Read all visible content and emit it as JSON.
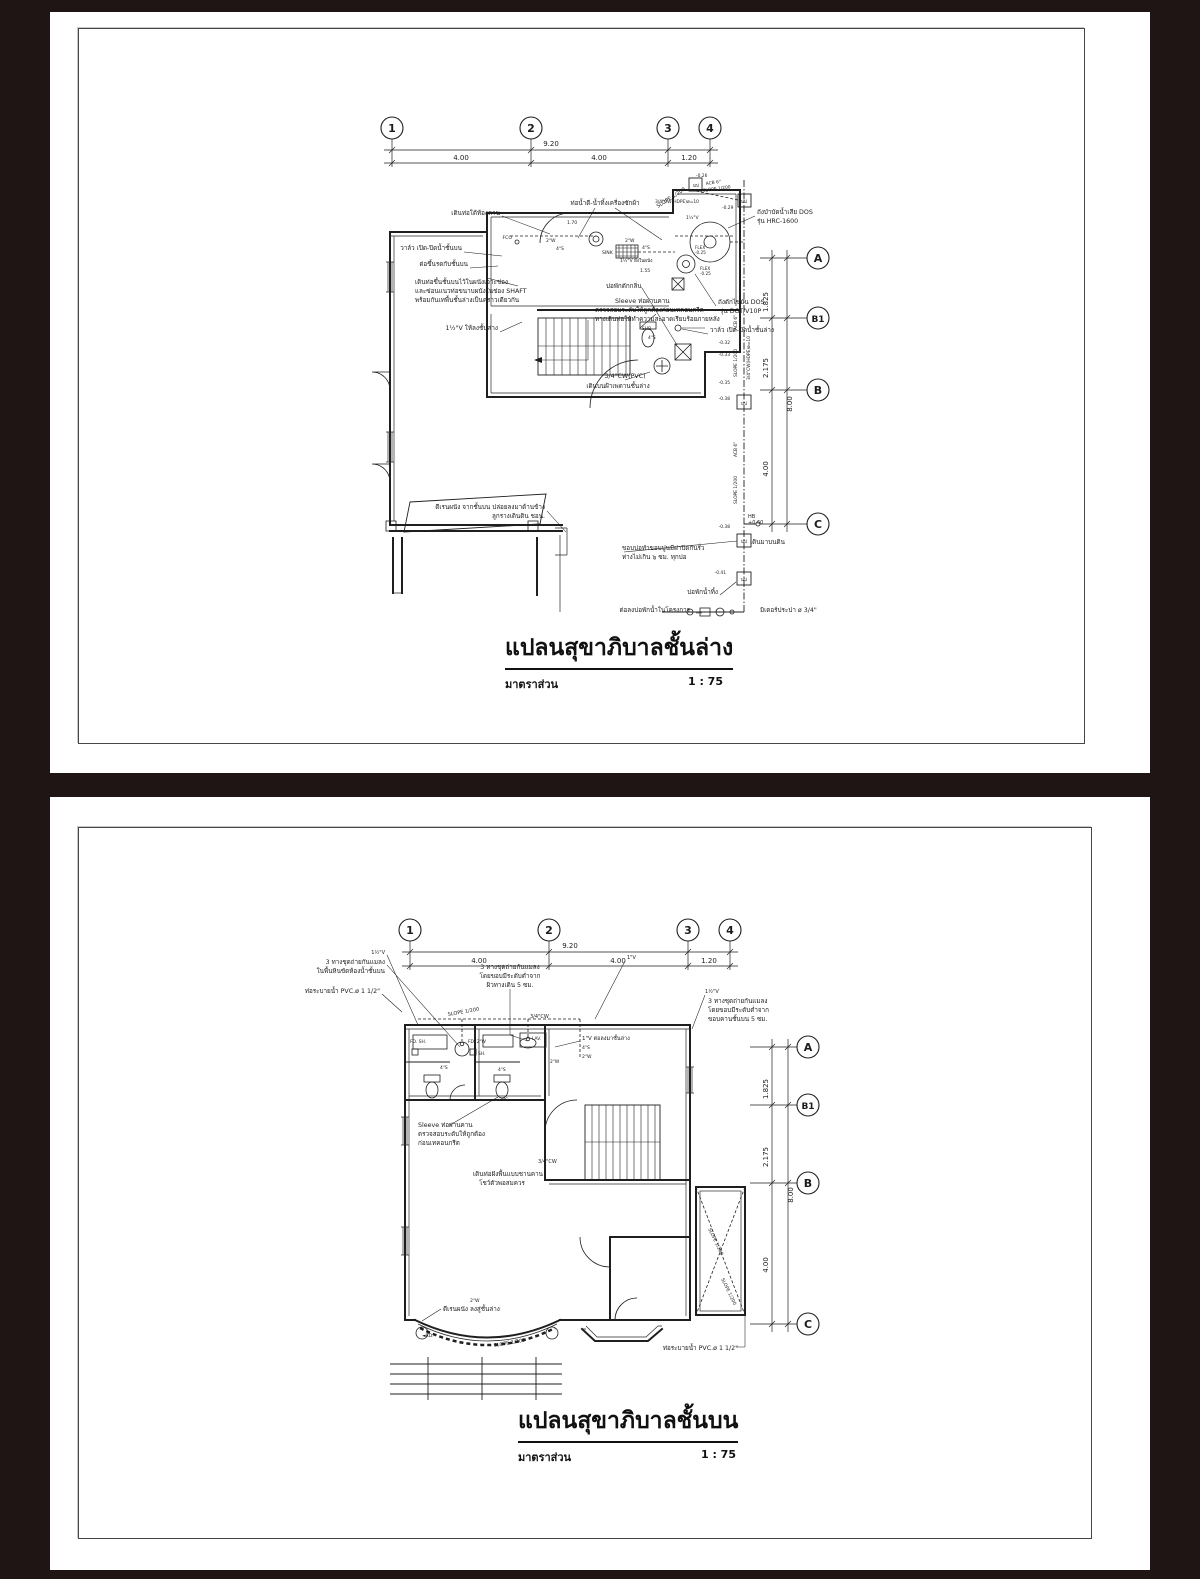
{
  "colors": {
    "background": "#1e1514",
    "paper": "#ffffff",
    "ink": "#1f1f1f",
    "frame": "#464646"
  },
  "pages": [
    {
      "title": "แปลนสุขาภิบาลชั้นล่าง",
      "scale_label": "มาตราส่วน",
      "scale_value": "1 : 75",
      "grid_columns": [
        "1",
        "2",
        "3",
        "4"
      ],
      "grid_rows": [
        "A",
        "B1",
        "B",
        "C"
      ],
      "dims_top": {
        "overall": "9.20",
        "seg1": "4.00",
        "seg2": "4.00",
        "seg3": "1.20"
      },
      "dims_right": {
        "overall": "8.00",
        "seg1": "1.825",
        "seg2": "2.175",
        "seg3": "4.00"
      },
      "annotations": [
        {
          "t": "ท่อน้ำดี-น้ำทิ้งเครื่องซักผ้า",
          "x": 555,
          "y": 193,
          "a": "m"
        },
        {
          "t": "เดินท่อใต้ท้องคาน",
          "x": 450,
          "y": 203,
          "a": "e"
        },
        {
          "t": "วาล์ว เปิด-ปิดน้ำชั้นบน",
          "x": 412,
          "y": 238,
          "a": "e"
        },
        {
          "t": "ต่อขึ้นรดกับชั้นบน",
          "x": 418,
          "y": 254,
          "a": "e"
        },
        {
          "t": "เดินท่อขึ้นชั้นบนไว้ในผนังเจาะช่อง",
          "x": 365,
          "y": 272
        },
        {
          "t": "และซ่อนแนวท่อขนาบผนังในช่อง SHAFT",
          "x": 365,
          "y": 281
        },
        {
          "t": "พร้อมกันเทพื้นชั้นล่างเป็นคราวเดียวกัน",
          "x": 365,
          "y": 290
        },
        {
          "t": "1½\"V ให้ลงชั้นล่าง",
          "x": 448,
          "y": 318,
          "a": "e"
        },
        {
          "t": "บ่อพักดักกลิ่น",
          "x": 556,
          "y": 276
        },
        {
          "t": "Sleeve ท่อผ่านคาน",
          "x": 565,
          "y": 291
        },
        {
          "t": "ตรวจสอบระดับให้ถูกต้องก่อนเทคอนกรีต",
          "x": 545,
          "y": 300
        },
        {
          "t": "ทางเดินท่อให้ทำความสะอาดเรียบร้อยภายหลัง",
          "x": 545,
          "y": 309
        },
        {
          "t": "3/4\"CW(PVC)",
          "x": 575,
          "y": 366,
          "a": "m"
        },
        {
          "t": "เดินบนฝ้าเพดานชั้นล่าง",
          "x": 568,
          "y": 376,
          "a": "m"
        },
        {
          "t": "ถังบำบัดน้ำเสีย DOS",
          "x": 707,
          "y": 202
        },
        {
          "t": "รุ่น HRC-1600",
          "x": 707,
          "y": 211
        },
        {
          "t": "ถังดักไขมัน DOS",
          "x": 668,
          "y": 292
        },
        {
          "t": "รุ่น DGT/V10P",
          "x": 670,
          "y": 301
        },
        {
          "t": "วาล์ว เปิด-ปิดน้ำชั้นล่าง",
          "x": 660,
          "y": 320
        },
        {
          "t": "ดีเรนผนัง จากชั้นบน ปล่อยลงมาด้านข้าง",
          "x": 495,
          "y": 497,
          "a": "e"
        },
        {
          "t": "ลูกรางเดินดิน ชอน.",
          "x": 495,
          "y": 506,
          "a": "e"
        },
        {
          "t": "ขอบบ่อทำขอบปูนมีฝาปิดกันรั่ว",
          "x": 572,
          "y": 538
        },
        {
          "t": "ห่างไม่เกิน ๖ ซม. ทุกบ่อ",
          "x": 572,
          "y": 547
        },
        {
          "t": "เดินมาบนดิน",
          "x": 700,
          "y": 532
        },
        {
          "t": "HB",
          "x": 698,
          "y": 506,
          "fs": 5
        },
        {
          "t": "+0.60",
          "x": 698,
          "y": 512,
          "fs": 5
        },
        {
          "t": "บ่อพักน้ำทิ้ง",
          "x": 668,
          "y": 582,
          "a": "e"
        },
        {
          "t": "ต่อลงบ่อพักน้ำในโครงการ",
          "x": 640,
          "y": 600,
          "a": "e"
        },
        {
          "t": "มิเตอร์ประปา ø 3/4\"",
          "x": 710,
          "y": 600
        },
        {
          "t": "SLOPE 1/200",
          "x": 608,
          "y": 196,
          "r": -33,
          "fs": 5.2
        },
        {
          "t": "SINK",
          "x": 552,
          "y": 242,
          "fs": 4.6
        },
        {
          "t": "FCO",
          "x": 462,
          "y": 227,
          "a": "e",
          "fs": 4.6
        },
        {
          "t": "2\"W",
          "x": 496,
          "y": 230,
          "fs": 4.6
        },
        {
          "t": "4\"S",
          "x": 506,
          "y": 238,
          "fs": 4.6
        },
        {
          "t": "2\"W",
          "x": 575,
          "y": 230,
          "fs": 4.6
        },
        {
          "t": "4\"S",
          "x": 592,
          "y": 237,
          "fs": 4.6
        },
        {
          "t": "1½\"V ฝังในผนัง",
          "x": 570,
          "y": 250,
          "fs": 4.6
        },
        {
          "t": "1.70",
          "x": 517,
          "y": 212,
          "fs": 4.6
        },
        {
          "t": "1.55",
          "x": 590,
          "y": 260,
          "fs": 4.6
        },
        {
          "t": "SHB",
          "x": 592,
          "y": 318,
          "fs": 4.4
        },
        {
          "t": "4\"S",
          "x": 598,
          "y": 327,
          "fs": 4.4
        },
        {
          "t": "-0.26",
          "x": 646,
          "y": 165,
          "fs": 4.4
        },
        {
          "t": "ACB 6\"",
          "x": 656,
          "y": 173,
          "r": -8,
          "fs": 4.4
        },
        {
          "t": "SLOPE 1/200",
          "x": 653,
          "y": 180,
          "r": -8,
          "fs": 4.4
        },
        {
          "t": "3/4\"CW(HDPE)ø=10",
          "x": 605,
          "y": 191,
          "fs": 4.4
        },
        {
          "t": "-0.29",
          "x": 672,
          "y": 197,
          "fs": 4.4
        },
        {
          "t": "1½\"V",
          "x": 636,
          "y": 207,
          "fs": 4.6
        },
        {
          "t": "FLEX",
          "x": 645,
          "y": 237,
          "fs": 4.2
        },
        {
          "t": "-0.25",
          "x": 645,
          "y": 242,
          "fs": 4.2
        },
        {
          "t": "FLEX",
          "x": 650,
          "y": 258,
          "fs": 4.2
        },
        {
          "t": "-0.25",
          "x": 650,
          "y": 263,
          "fs": 4.2
        },
        {
          "t": "-0.32",
          "x": 680,
          "y": 332,
          "a": "e",
          "fs": 4.4
        },
        {
          "t": "-0.33",
          "x": 680,
          "y": 344,
          "a": "e",
          "fs": 4.4
        },
        {
          "t": "-0.35",
          "x": 680,
          "y": 372,
          "a": "e",
          "fs": 4.4
        },
        {
          "t": "-0.38",
          "x": 680,
          "y": 388,
          "a": "e",
          "fs": 4.4
        },
        {
          "t": "-0.38",
          "x": 680,
          "y": 516,
          "a": "e",
          "fs": 4.4
        },
        {
          "t": "-0.41",
          "x": 676,
          "y": 562,
          "a": "e",
          "fs": 4.4
        },
        {
          "t": "SLOPE 1/200",
          "x": 687,
          "y": 365,
          "r": -90,
          "fs": 4.4
        },
        {
          "t": "ACB 6\"",
          "x": 687,
          "y": 318,
          "r": -90,
          "fs": 4.4
        },
        {
          "t": "3/4\"CW(HDPE)ø=10",
          "x": 700,
          "y": 368,
          "r": -90,
          "fs": 4.4
        },
        {
          "t": "SLOPE 1/200",
          "x": 687,
          "y": 492,
          "r": -90,
          "fs": 4.4
        },
        {
          "t": "ACB 6\"",
          "x": 687,
          "y": 445,
          "r": -90,
          "fs": 4.4
        },
        {
          "t": "มป",
          "x": 694,
          "y": 393,
          "a": "m",
          "fs": 4.6
        },
        {
          "t": "มป",
          "x": 694,
          "y": 531,
          "a": "m",
          "fs": 4.6
        },
        {
          "t": "มป",
          "x": 694,
          "y": 569,
          "a": "m",
          "fs": 4.6
        },
        {
          "t": "มป",
          "x": 646,
          "y": 175,
          "a": "m",
          "fs": 4.6
        },
        {
          "t": "มป",
          "x": 694,
          "y": 191,
          "a": "m",
          "fs": 4.6
        }
      ]
    },
    {
      "title": "แปลนสุขาภิบาลชั้นบน",
      "scale_label": "มาตราส่วน",
      "scale_value": "1 : 75",
      "grid_columns": [
        "1",
        "2",
        "3",
        "4"
      ],
      "grid_rows": [
        "A",
        "B1",
        "B",
        "C"
      ],
      "dims_top": {
        "overall": "9.20",
        "seg1": "4.00",
        "seg2": "4.00",
        "seg3": "1.20"
      },
      "dims_right": {
        "overall": "8.00",
        "seg1": "1.825",
        "seg2": "2.175",
        "seg3": "4.00"
      },
      "annotations": [
        {
          "t": "1½\"V",
          "x": 335,
          "y": 157,
          "a": "e",
          "fs": 5
        },
        {
          "t": "3 ทางชุดถ่ายกันแมลง",
          "x": 335,
          "y": 167,
          "a": "e"
        },
        {
          "t": "ในพื้นหินขัดห้องน้ำชั้นบน",
          "x": 335,
          "y": 176,
          "a": "e"
        },
        {
          "t": "ท่อระบายน้ำ PVC.ø 1 1/2\"",
          "x": 330,
          "y": 196,
          "a": "e"
        },
        {
          "t": "3 ทางชุดถ่ายกันแมลง",
          "x": 460,
          "y": 172,
          "a": "m"
        },
        {
          "t": "โดยขอบมีระดับต่ำจาก",
          "x": 460,
          "y": 181,
          "a": "m"
        },
        {
          "t": "ผิวทางเดิน 5 ซม.",
          "x": 460,
          "y": 190,
          "a": "m"
        },
        {
          "t": "1\"V",
          "x": 577,
          "y": 162,
          "fs": 5
        },
        {
          "t": "1½\"V",
          "x": 655,
          "y": 196,
          "fs": 5
        },
        {
          "t": "3 ทางชุดถ่ายกันแมลง",
          "x": 658,
          "y": 206
        },
        {
          "t": "โดยขอบมีระดับต่ำจาก",
          "x": 658,
          "y": 215
        },
        {
          "t": "ขอบคานชั้นบน 5 ซม.",
          "x": 658,
          "y": 224
        },
        {
          "t": "SLOPE 1/200",
          "x": 398,
          "y": 219,
          "r": -10,
          "fs": 5
        },
        {
          "t": "3/4\"CW",
          "x": 480,
          "y": 221,
          "fs": 5
        },
        {
          "t": "1\"V ต่อลงมาชั้นล่าง",
          "x": 532,
          "y": 243,
          "fs": 5.5
        },
        {
          "t": "4\"S",
          "x": 532,
          "y": 252,
          "fs": 4.6
        },
        {
          "t": "2\"W",
          "x": 532,
          "y": 261,
          "fs": 4.6
        },
        {
          "t": "FD. SH.",
          "x": 360,
          "y": 246,
          "fs": 4.4
        },
        {
          "t": "FD. 2\"W",
          "x": 418,
          "y": 246,
          "fs": 4.4
        },
        {
          "t": "SH.",
          "x": 428,
          "y": 258,
          "fs": 4.4
        },
        {
          "t": "LAV.",
          "x": 482,
          "y": 243,
          "fs": 4.4
        },
        {
          "t": "WC.",
          "x": 455,
          "y": 304,
          "a": "m",
          "fs": 4.4
        },
        {
          "t": "4\"S",
          "x": 390,
          "y": 272,
          "fs": 4.4
        },
        {
          "t": "4\"S",
          "x": 448,
          "y": 274,
          "fs": 4.4
        },
        {
          "t": "2\"W",
          "x": 500,
          "y": 266,
          "fs": 4.4
        },
        {
          "t": "Sleeve ท่อผ่านคาน",
          "x": 368,
          "y": 330
        },
        {
          "t": "ตรวจสอบระดับให้ถูกต้อง",
          "x": 368,
          "y": 339
        },
        {
          "t": "ก่อนเทคอนกรีต",
          "x": 368,
          "y": 348
        },
        {
          "t": "3/4\"CW",
          "x": 488,
          "y": 366,
          "fs": 5
        },
        {
          "t": "เดินท่อฝังพื้นแบบชานคาน",
          "x": 458,
          "y": 379,
          "a": "m"
        },
        {
          "t": "โชว์ตัวพอสมควร",
          "x": 452,
          "y": 388,
          "a": "m"
        },
        {
          "t": "2\"W",
          "x": 420,
          "y": 505,
          "fs": 4.6
        },
        {
          "t": "ดีเรนผนัง ลงสู่ชั้นล่าง",
          "x": 393,
          "y": 514
        },
        {
          "t": "◄RD.",
          "x": 372,
          "y": 540,
          "fs": 4.6
        },
        {
          "t": "SLOPE 1/200",
          "x": 444,
          "y": 550,
          "r": -10,
          "fs": 5
        },
        {
          "t": "SLOPE 1/200",
          "x": 658,
          "y": 432,
          "r": 64,
          "fs": 4.6
        },
        {
          "t": "SLOPE 1/200",
          "x": 671,
          "y": 482,
          "r": 64,
          "fs": 4.6
        },
        {
          "t": "ท่อระบายน้ำ PVC.ø 1 1/2\"",
          "x": 688,
          "y": 553,
          "a": "e"
        }
      ]
    }
  ]
}
